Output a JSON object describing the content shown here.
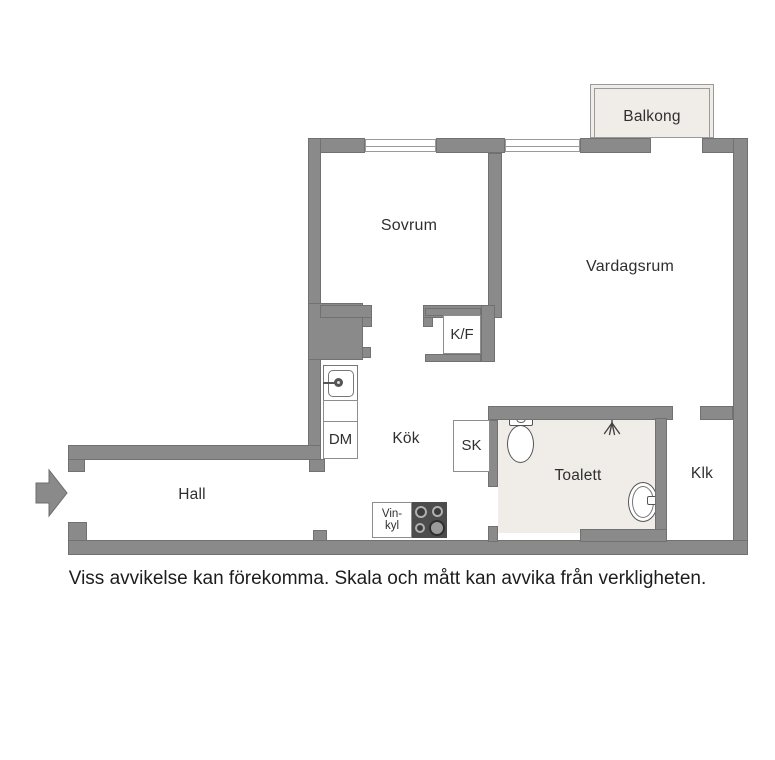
{
  "disclaimer": "Viss avvikelse kan förekomma. Skala och mått kan avvika från verkligheten.",
  "rooms": {
    "balkong": {
      "label": "Balkong"
    },
    "sovrum": {
      "label": "Sovrum"
    },
    "vardagsrum": {
      "label": "Vardagsrum"
    },
    "kok": {
      "label": "Kök"
    },
    "hall": {
      "label": "Hall"
    },
    "toalett": {
      "label": "Toalett"
    },
    "klk": {
      "label": "Klk"
    }
  },
  "fixtures": {
    "fridge_freezer": {
      "label": "K/F"
    },
    "dishwasher": {
      "label": "DM"
    },
    "cabinet": {
      "label": "SK"
    },
    "wine_fridge": {
      "label_line1": "Vin-",
      "label_line2": "kyl"
    }
  },
  "colors": {
    "wall": "#8a8a8a",
    "wall_edge": "#717171",
    "room_fill": "#f0ede8",
    "text": "#2f2f2f",
    "stove": "#4c4c4c"
  }
}
